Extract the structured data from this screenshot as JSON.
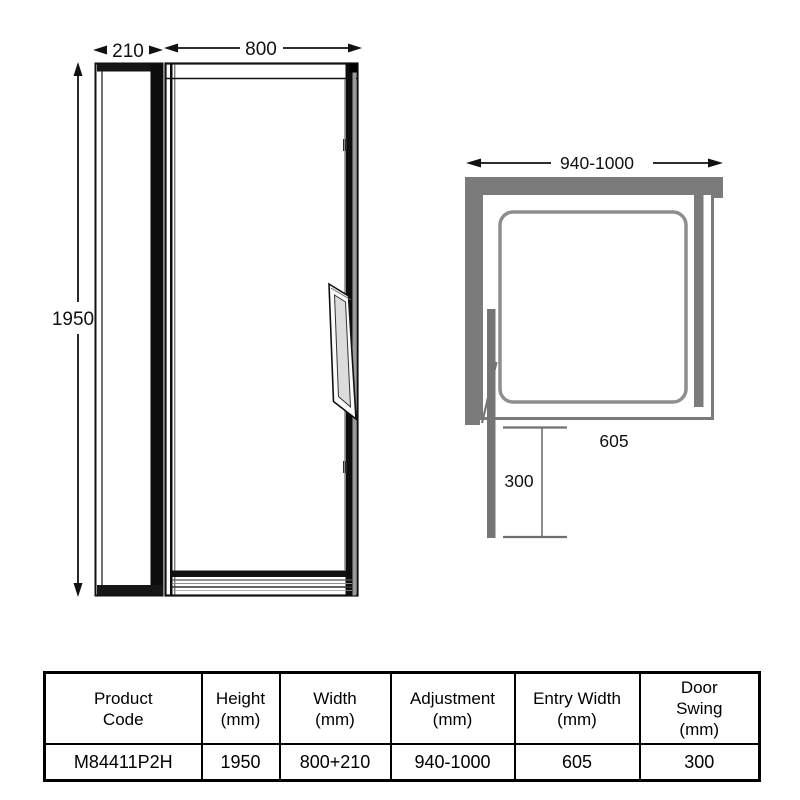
{
  "elevation": {
    "dim_side_width": "210",
    "dim_door_width": "800",
    "dim_height": "1950"
  },
  "plan": {
    "dim_width": "940-1000",
    "dim_entry_width": "605",
    "dim_door_swing": "300"
  },
  "table": {
    "columns": [
      {
        "lines": [
          "Product",
          "Code"
        ]
      },
      {
        "lines": [
          "Height",
          "(mm)"
        ]
      },
      {
        "lines": [
          "Width",
          "(mm)"
        ]
      },
      {
        "lines": [
          "Adjustment",
          "(mm)"
        ]
      },
      {
        "lines": [
          "Entry Width",
          "(mm)"
        ]
      },
      {
        "lines": [
          "Door",
          "Swing",
          "(mm)"
        ]
      }
    ],
    "row": [
      "M84411P2H",
      "1950",
      "800+210",
      "940-1000",
      "605",
      "300"
    ]
  },
  "colors": {
    "wall_gray": "#7b7b7b",
    "door_gray": "#757575",
    "tray_gray": "#8e8e8e",
    "line_black": "#111111"
  }
}
